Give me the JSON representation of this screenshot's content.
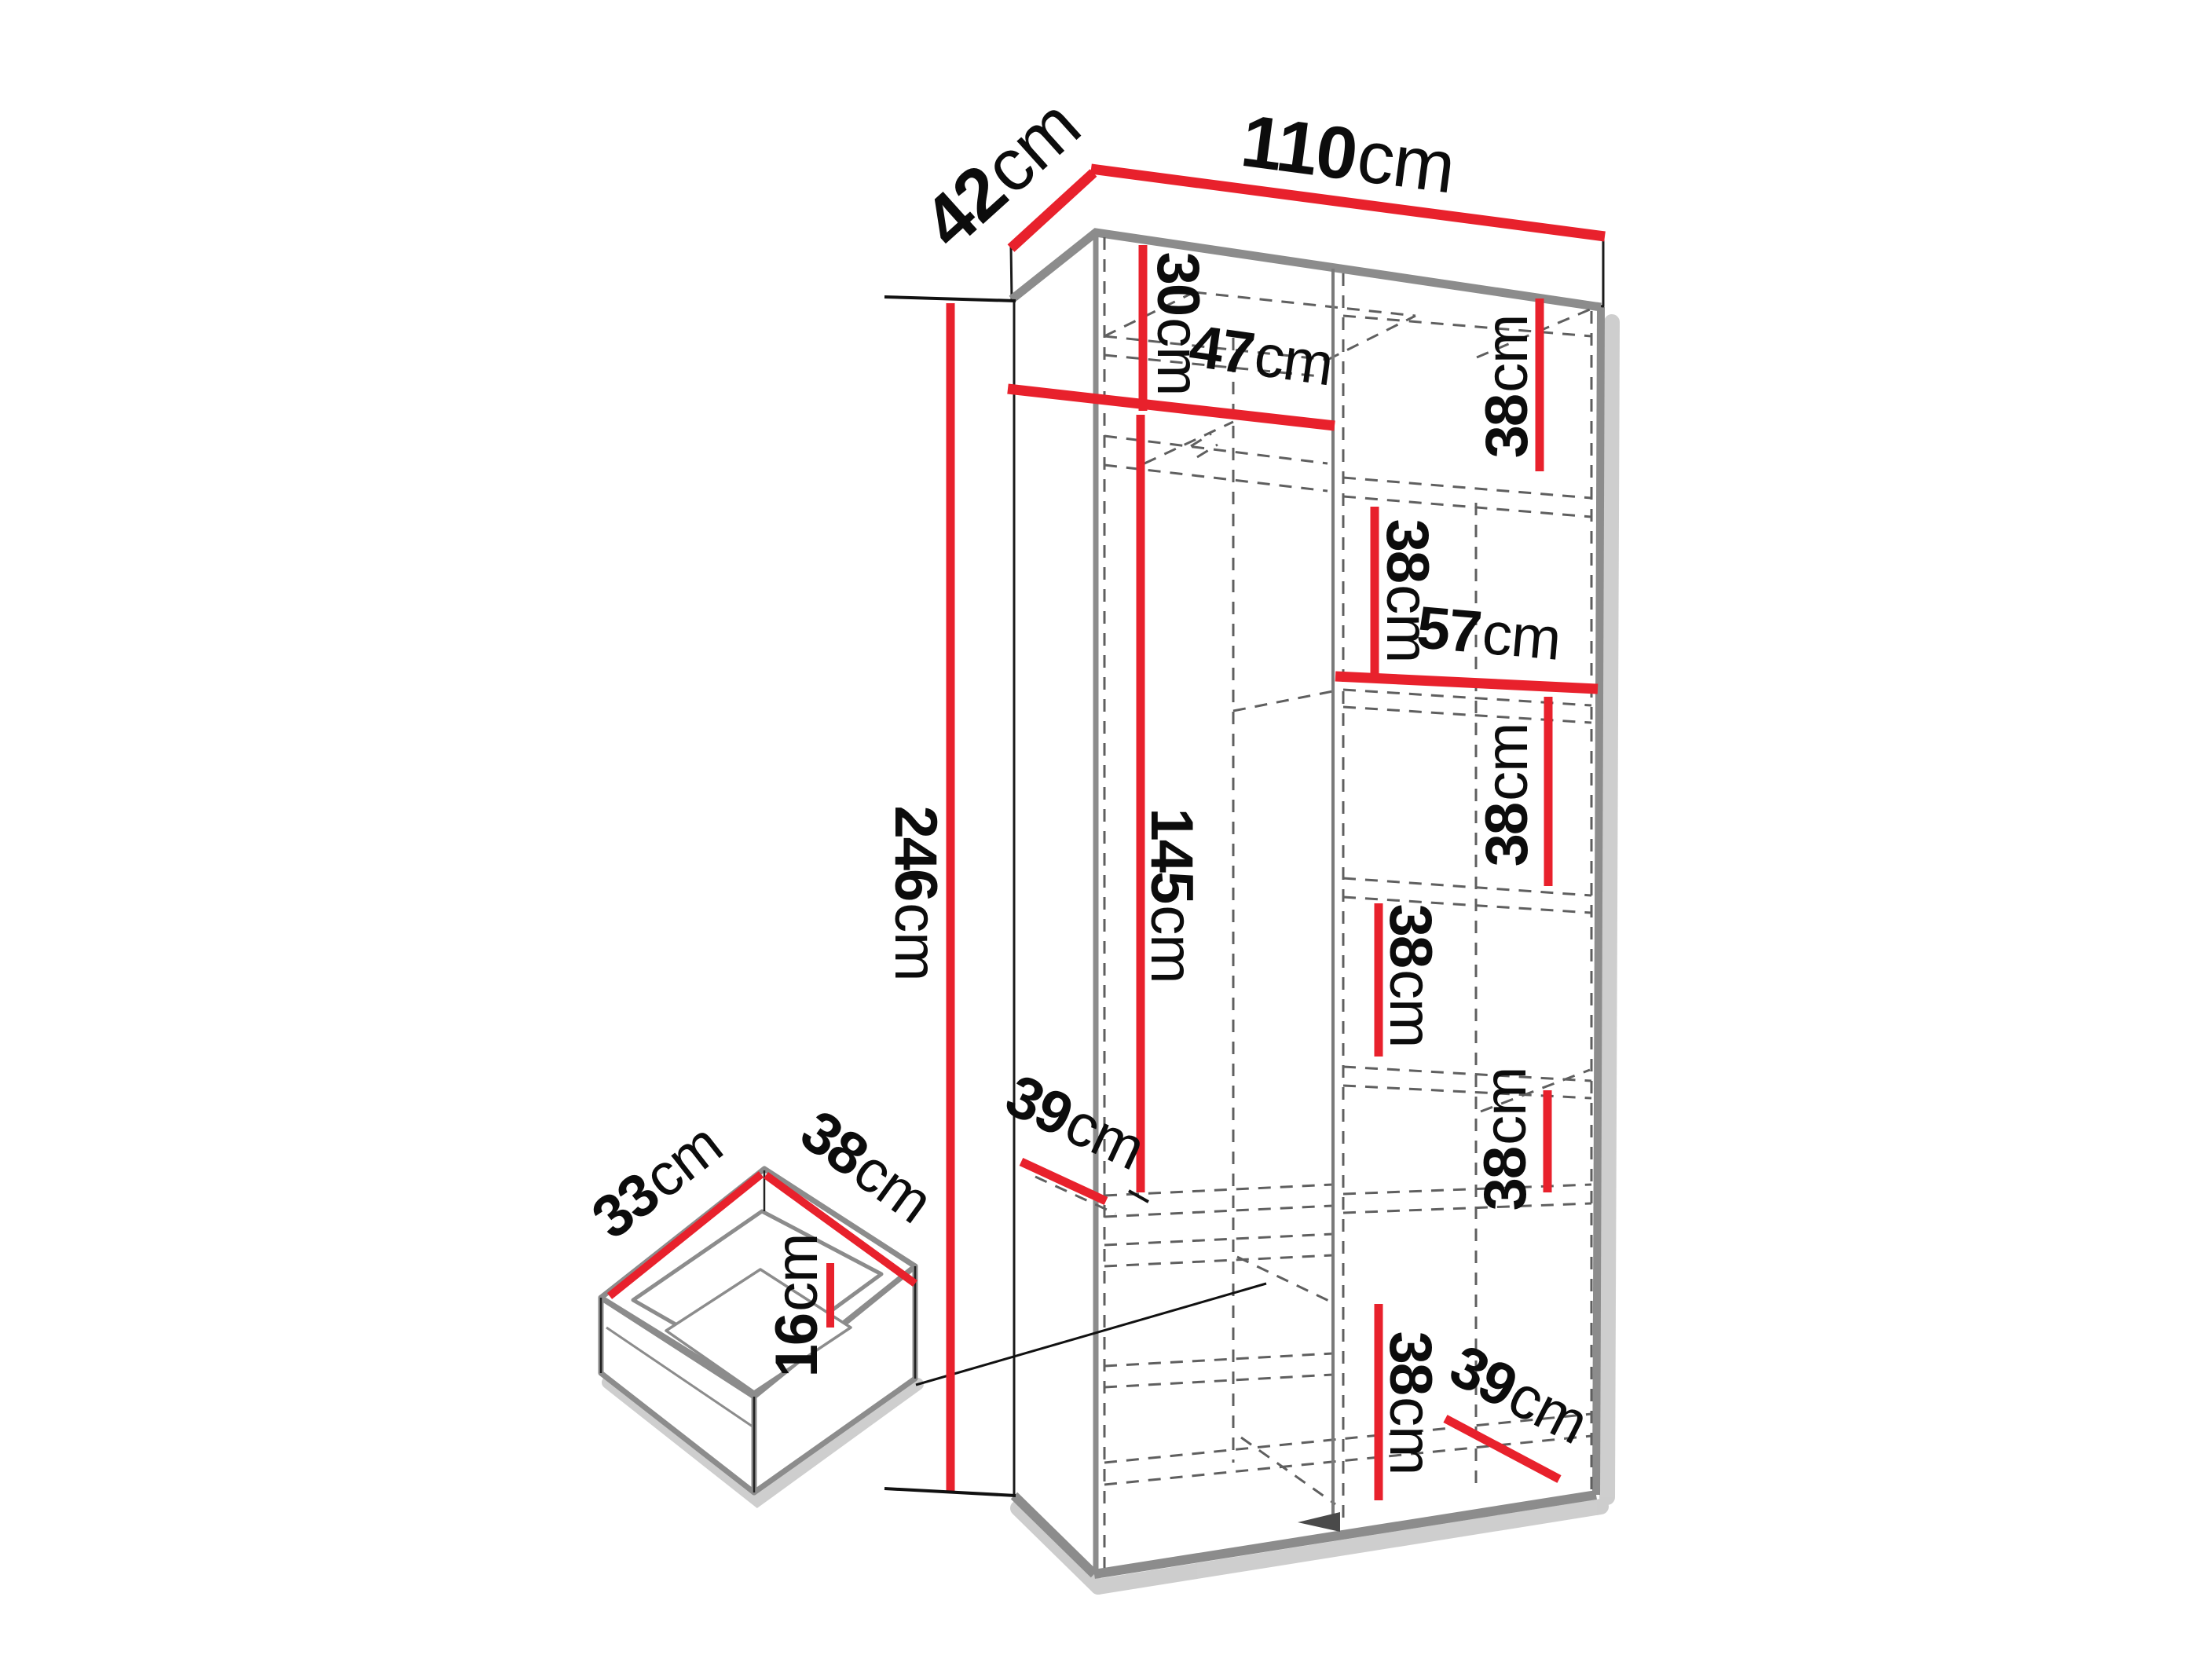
{
  "diagram": {
    "kind": "furniture-dimension-diagram",
    "subject": "tall two-column wardrobe carcass with shelf layout and pull-out drawer detail",
    "background": "#ffffff"
  },
  "colors": {
    "dimension_red": "#e8212c",
    "outline_black": "#1a1a1a",
    "structure_gray": "#8c8c8c",
    "shadow_gray": "#bdbdbd",
    "dashed_gray": "#5f5f5f"
  },
  "overall": {
    "width": {
      "value": "110",
      "unit": "cm"
    },
    "depth": {
      "value": "42",
      "unit": "cm"
    },
    "height": {
      "value": "246",
      "unit": "cm"
    }
  },
  "left_column": {
    "top_compartment_height": {
      "value": "30",
      "unit": "cm"
    },
    "shelf_width": {
      "value": "47",
      "unit": "cm"
    },
    "hanging_space_height": {
      "value": "145",
      "unit": "cm"
    },
    "shelf_depth": {
      "value": "39",
      "unit": "cm"
    }
  },
  "right_column": {
    "shelf_width": {
      "value": "57",
      "unit": "cm"
    },
    "shelf_depth": {
      "value": "39",
      "unit": "cm"
    },
    "compartment_heights": [
      {
        "value": "38",
        "unit": "cm"
      },
      {
        "value": "38",
        "unit": "cm"
      },
      {
        "value": "38",
        "unit": "cm"
      },
      {
        "value": "38",
        "unit": "cm"
      },
      {
        "value": "38",
        "unit": "cm"
      },
      {
        "value": "38",
        "unit": "cm"
      }
    ]
  },
  "drawer": {
    "inner_depth": {
      "value": "33",
      "unit": "cm"
    },
    "inner_width": {
      "value": "38",
      "unit": "cm"
    },
    "inner_height": {
      "value": "16",
      "unit": "cm"
    }
  }
}
